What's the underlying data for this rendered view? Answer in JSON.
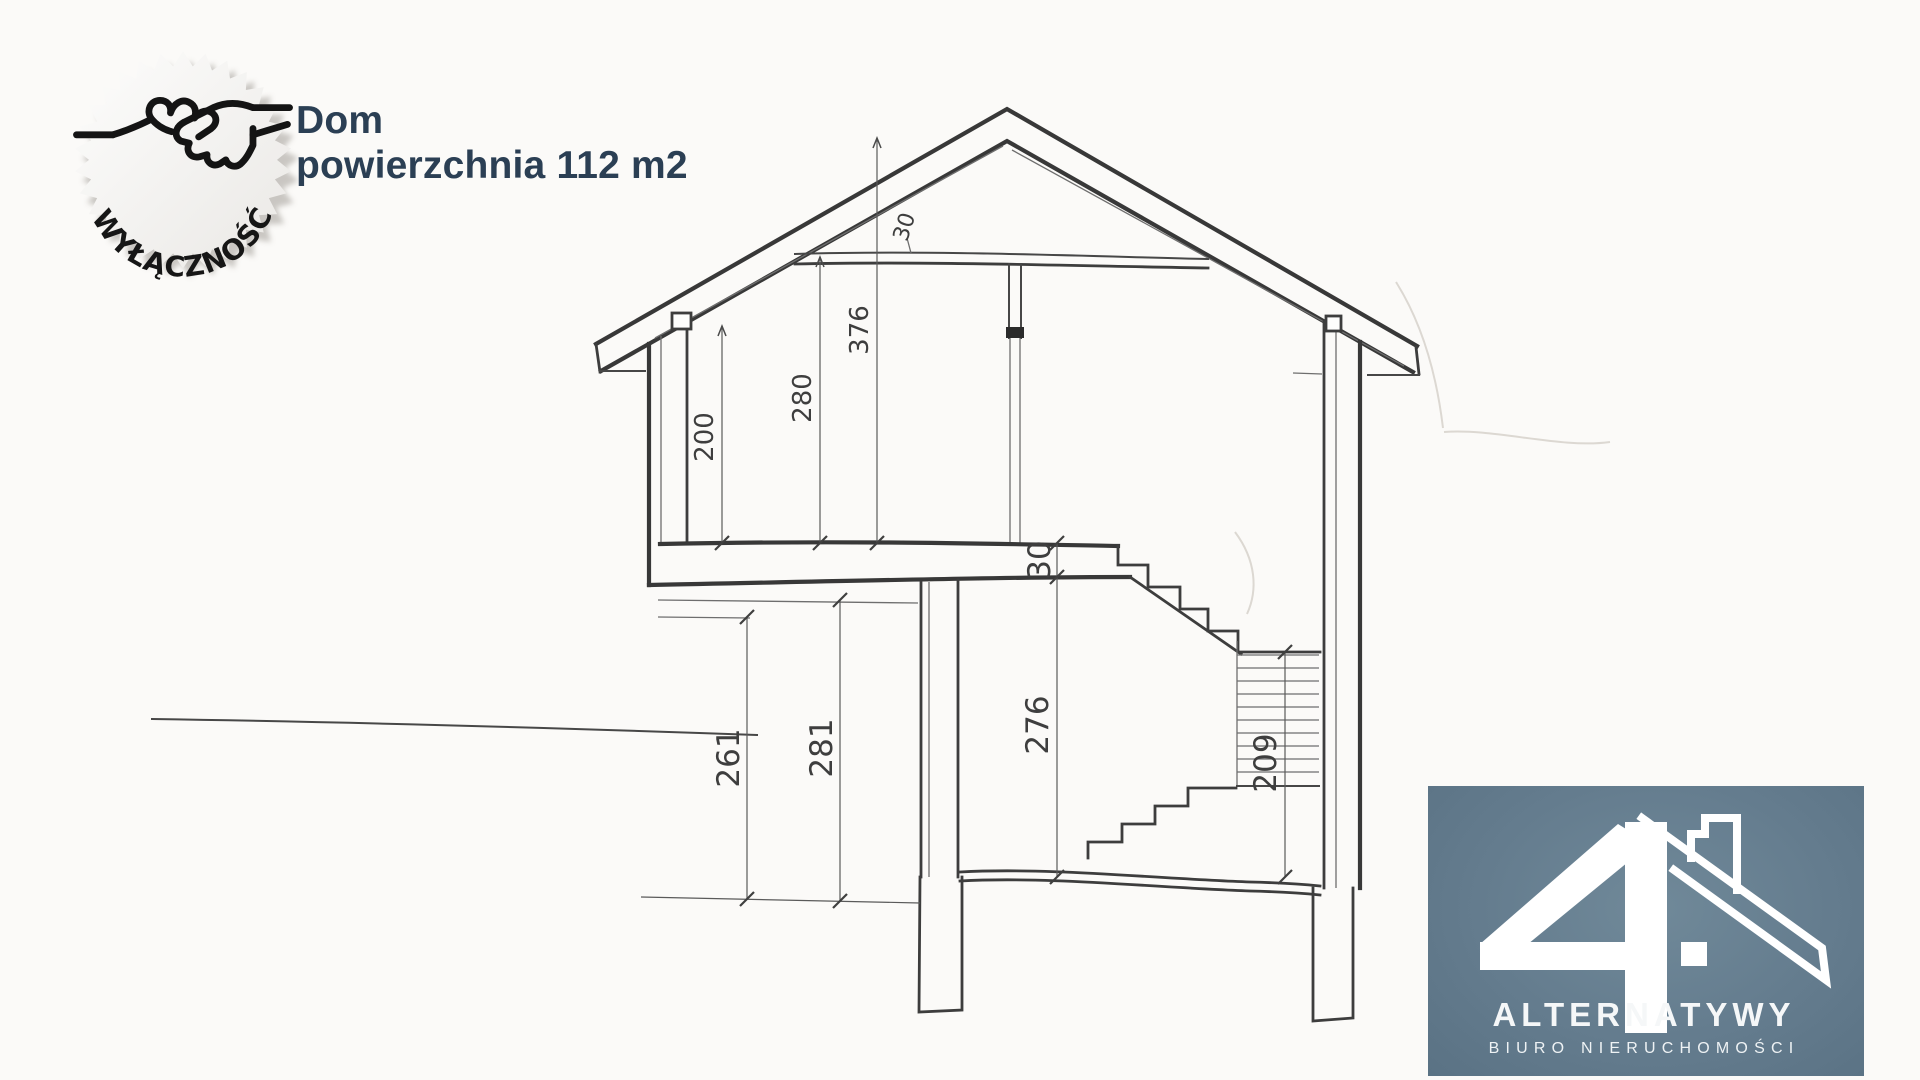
{
  "page": {
    "background": "#fbfaf8"
  },
  "badge": {
    "label": "WYŁĄCZNOŚĆ",
    "icon": "handshake-icon",
    "fill": "#f6f4f2",
    "text_color": "#161616"
  },
  "title": {
    "line1": "Dom",
    "line2": "powierzchnia 112 m2",
    "color": "#2b3f54"
  },
  "drawing": {
    "type": "house-cross-section-scan",
    "line_color": "#3d3d3d",
    "dims": {
      "wall_height": "200",
      "room_height_upper": "280",
      "ridge_height": "376",
      "collar_thickness": "30",
      "slab_thickness": "30",
      "room_height_lower": "276",
      "overhang_left": "261",
      "overhang_right": "281",
      "stair_height": "209"
    }
  },
  "logo": {
    "number": "4",
    "name": "ALTERNATYWY",
    "subtitle": "BIURO NIERUCHOMOŚCI",
    "bg": "#637b8d",
    "fg": "#ffffff"
  }
}
